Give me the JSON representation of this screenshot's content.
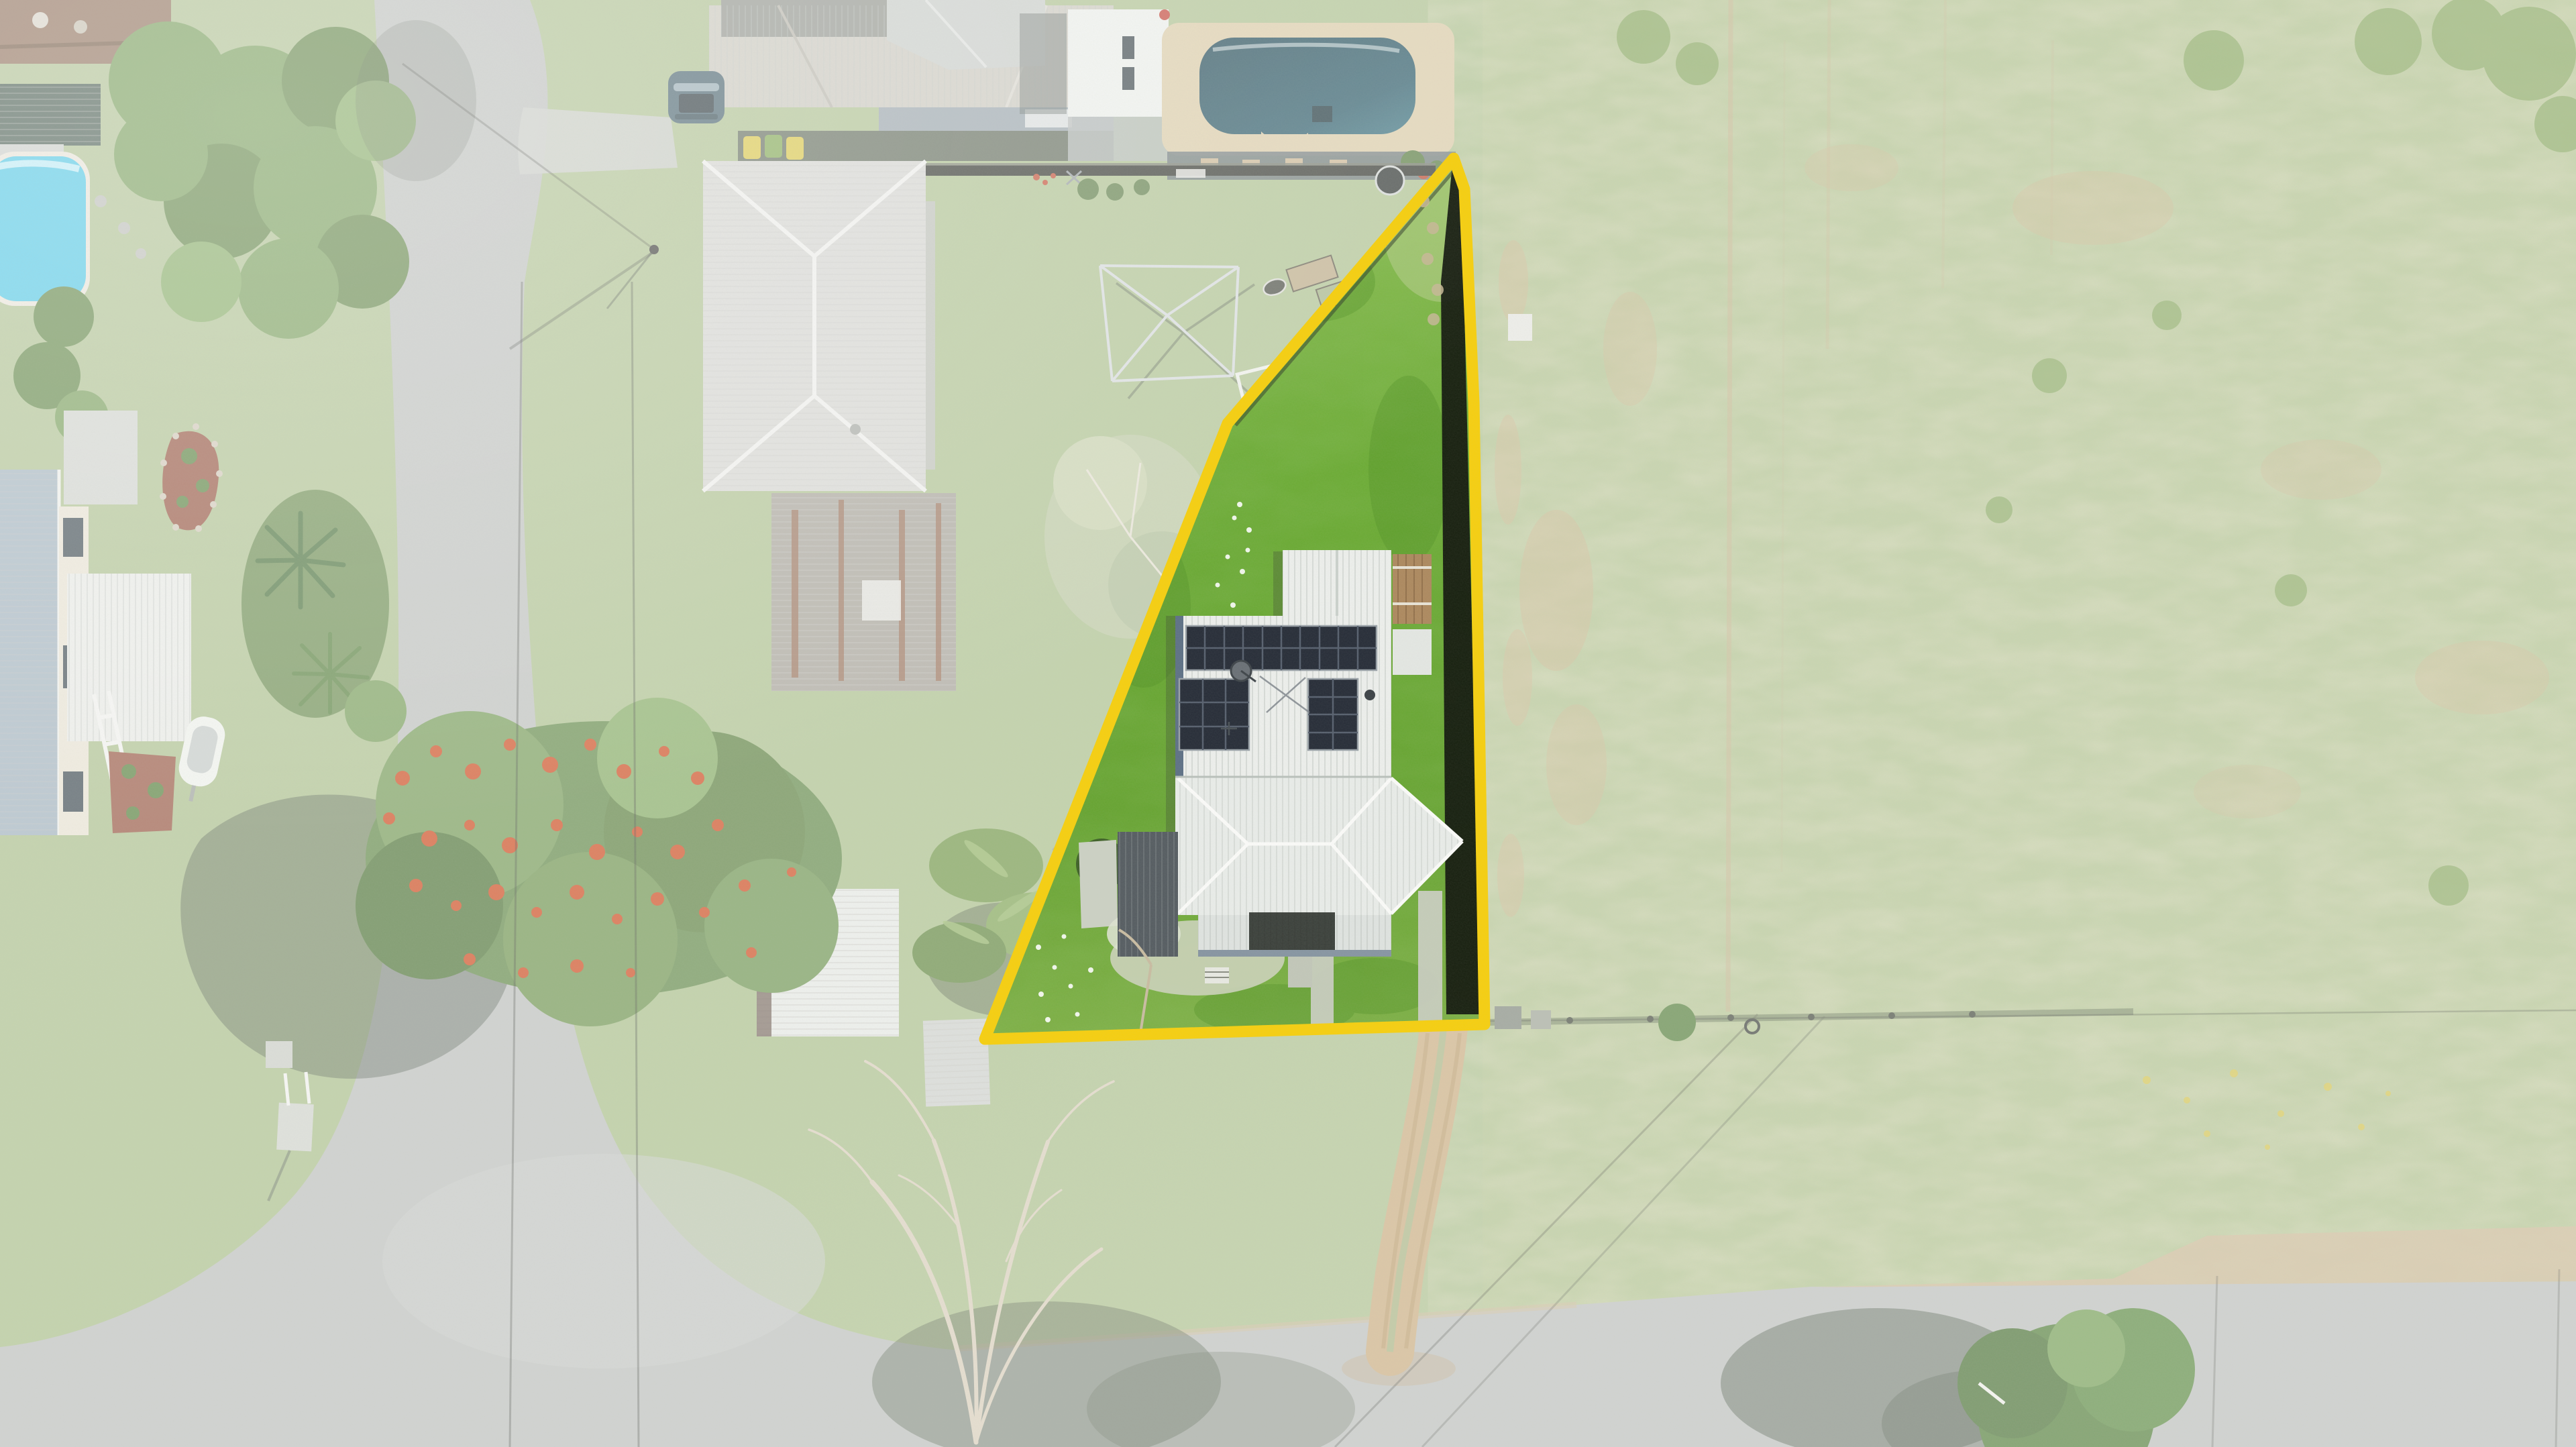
{
  "meta": {
    "image_kind": "aerial drone photograph",
    "subject": "residential allotment highlighted with a yellow boundary outline",
    "visible_text": "none"
  },
  "colors": {
    "boundary_yellow": "#F6CF10",
    "base_grass": "#A6BD85",
    "field_grass": "#AEC08A",
    "lot_grass_top": "#8CBF55",
    "lot_grass_main": "#67A432",
    "road": "#B9BDB9",
    "dirt_track": "#C8AA7C",
    "roof_white": "#EDEFEC",
    "roof_neighbor_north": "#C8C5BB",
    "roof_neighbor_west": "#D3D3CF",
    "roof_rusty_shed": "#A19D92",
    "carport_dark": "#565D62",
    "solar_panel": "#272D38",
    "pool_top": "#174653",
    "pool_coping": "#D9C8A2",
    "pool_left": "#47C5E6",
    "poinciana_bloom": "#CC4314",
    "tree_canopy": "#5C8440",
    "fence_dark": "#23271F",
    "fence_shadow_band": "#11150D",
    "shadow": "#2F3B2F",
    "white_wash": "#FFFFFF"
  },
  "scene": {
    "highlighted_lot": {
      "shape": "tapered block, pointed rear corner at top, street frontage at bottom",
      "features": [
        "white corrugated-metal roofed house",
        "three rooftop solar panel arrays",
        "satellite dish on roof",
        "dark carport on west side",
        "rear gabled shed with timber deck",
        "two concrete driveway strips to street",
        "bright green lawn",
        "daisy patches along west fence",
        "dark paling fence with shadow along east boundary"
      ]
    },
    "surroundings": [
      "grey bitumen road along west side",
      "grey bitumen road along bottom",
      "dirt driveway track crossing grass verge",
      "large open paddock on right with mottled dry patches",
      "neighbour house with grey hip roof at top centre",
      "dark SUV parked beside neighbour house",
      "wheelie bins",
      "neighbour backyard swimming pool (dark teal) with sandstone surround at top",
      "round trampoline",
      "rotary clothesline frame",
      "neighbour house with large pale hip roof at left centre",
      "rusty-roofed garage",
      "white garden sheds",
      "boat on trailer",
      "turquoise pool at far left edge",
      "poinciana tree with orange blossoms",
      "palm garden",
      "leafless tree over bottom road",
      "green tree with long shadow at bottom right",
      "power lines crossing road"
    ]
  }
}
